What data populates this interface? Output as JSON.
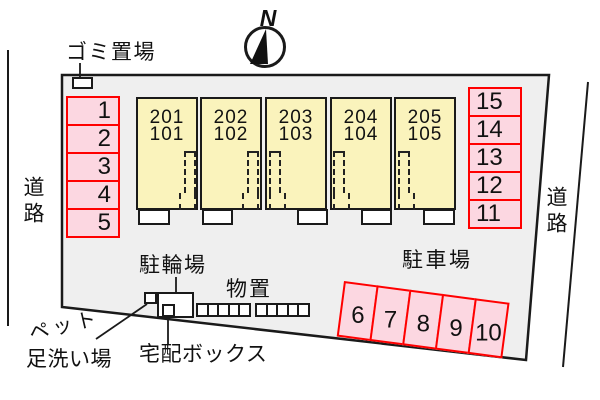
{
  "north": {
    "label": "N"
  },
  "roads": {
    "left": "道路",
    "right": "道路"
  },
  "garbage": {
    "label": "ゴミ置場"
  },
  "building": {
    "units": [
      {
        "upper": "201",
        "lower": "101"
      },
      {
        "upper": "202",
        "lower": "102"
      },
      {
        "upper": "203",
        "lower": "103"
      },
      {
        "upper": "204",
        "lower": "104"
      },
      {
        "upper": "205",
        "lower": "105"
      }
    ]
  },
  "parking": {
    "lot_label": "駐車場",
    "left_column": [
      "1",
      "2",
      "3",
      "4",
      "5"
    ],
    "right_column": [
      "15",
      "14",
      "13",
      "12",
      "11"
    ],
    "bottom_row": [
      "6",
      "7",
      "8",
      "9",
      "10"
    ]
  },
  "facilities": {
    "bicycle_label": "駐輪場",
    "storage_label": "物置",
    "delivery_label": "宅配ボックス",
    "pet_label_line1": "ペット",
    "pet_label_line2": "足洗い場"
  },
  "colors": {
    "site_fill": "#efefef",
    "building_fill": "#faf3bc",
    "parking_fill": "#fcd7e1",
    "parking_border": "#ff0000",
    "line": "#1a1a1a"
  }
}
